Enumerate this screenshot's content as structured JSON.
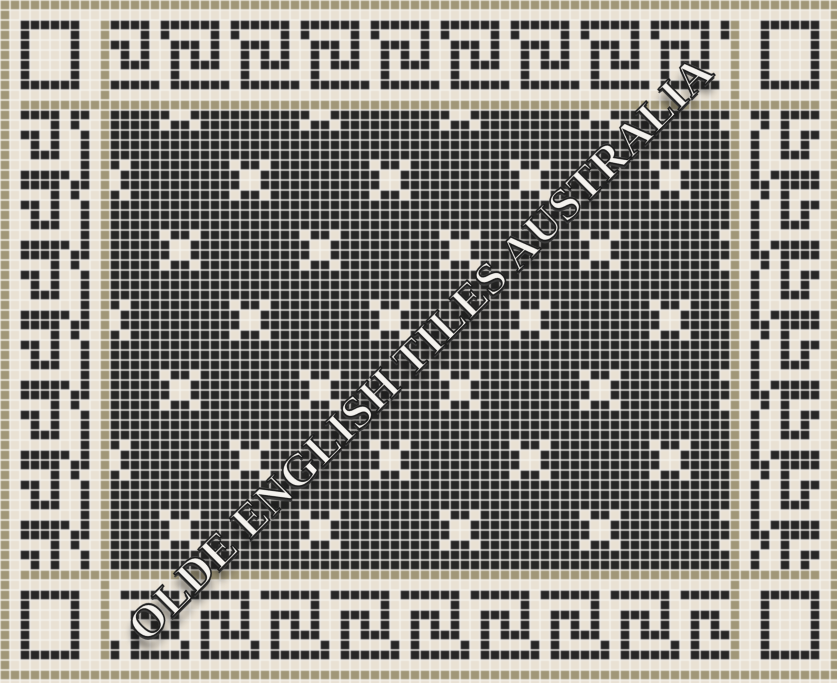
{
  "image": {
    "kind": "mosaic-tile-pattern",
    "width_px": 837,
    "height_px": 683
  },
  "watermark": {
    "text": "OLDE ENGLISH TILES AUSTRALIA",
    "angle_deg": -45,
    "fill_color": "#f4f2ee",
    "outline_color": "#1c1c1c"
  },
  "mosaic": {
    "tile_px": 10,
    "grid_cols": 84,
    "grid_rows": 69,
    "colors": {
      "black": "#272726",
      "cream": "#e9e1d3",
      "tan": "#a19778",
      "grout": "#f6f4ef"
    },
    "frame": {
      "outer_tan": 0,
      "outer_cream": 1,
      "key_band_start": 2,
      "key_band_end": 8,
      "inner_cream": 9,
      "inner_tan": 10,
      "field_start": 11,
      "mirror_row": 67,
      "mirror_col": 83,
      "bottom_partial_row": 68,
      "row_flip_after": 33
    },
    "key_unit": [
      "XXXX.XX",
      "...X.X.",
      "XX.X..X",
      ".X.X..X",
      ".XXX..X",
      "......X",
      "XXXXX.X"
    ],
    "corner_box": {
      "width": 6,
      "height": 7
    },
    "motif": {
      "pattern": [
        "X..X",
        ".XX.",
        ".XX.",
        "X..X"
      ],
      "period": 14,
      "family_a": {
        "row": 9,
        "col": 16
      },
      "family_b": {
        "row": 16,
        "col": 9
      }
    }
  }
}
